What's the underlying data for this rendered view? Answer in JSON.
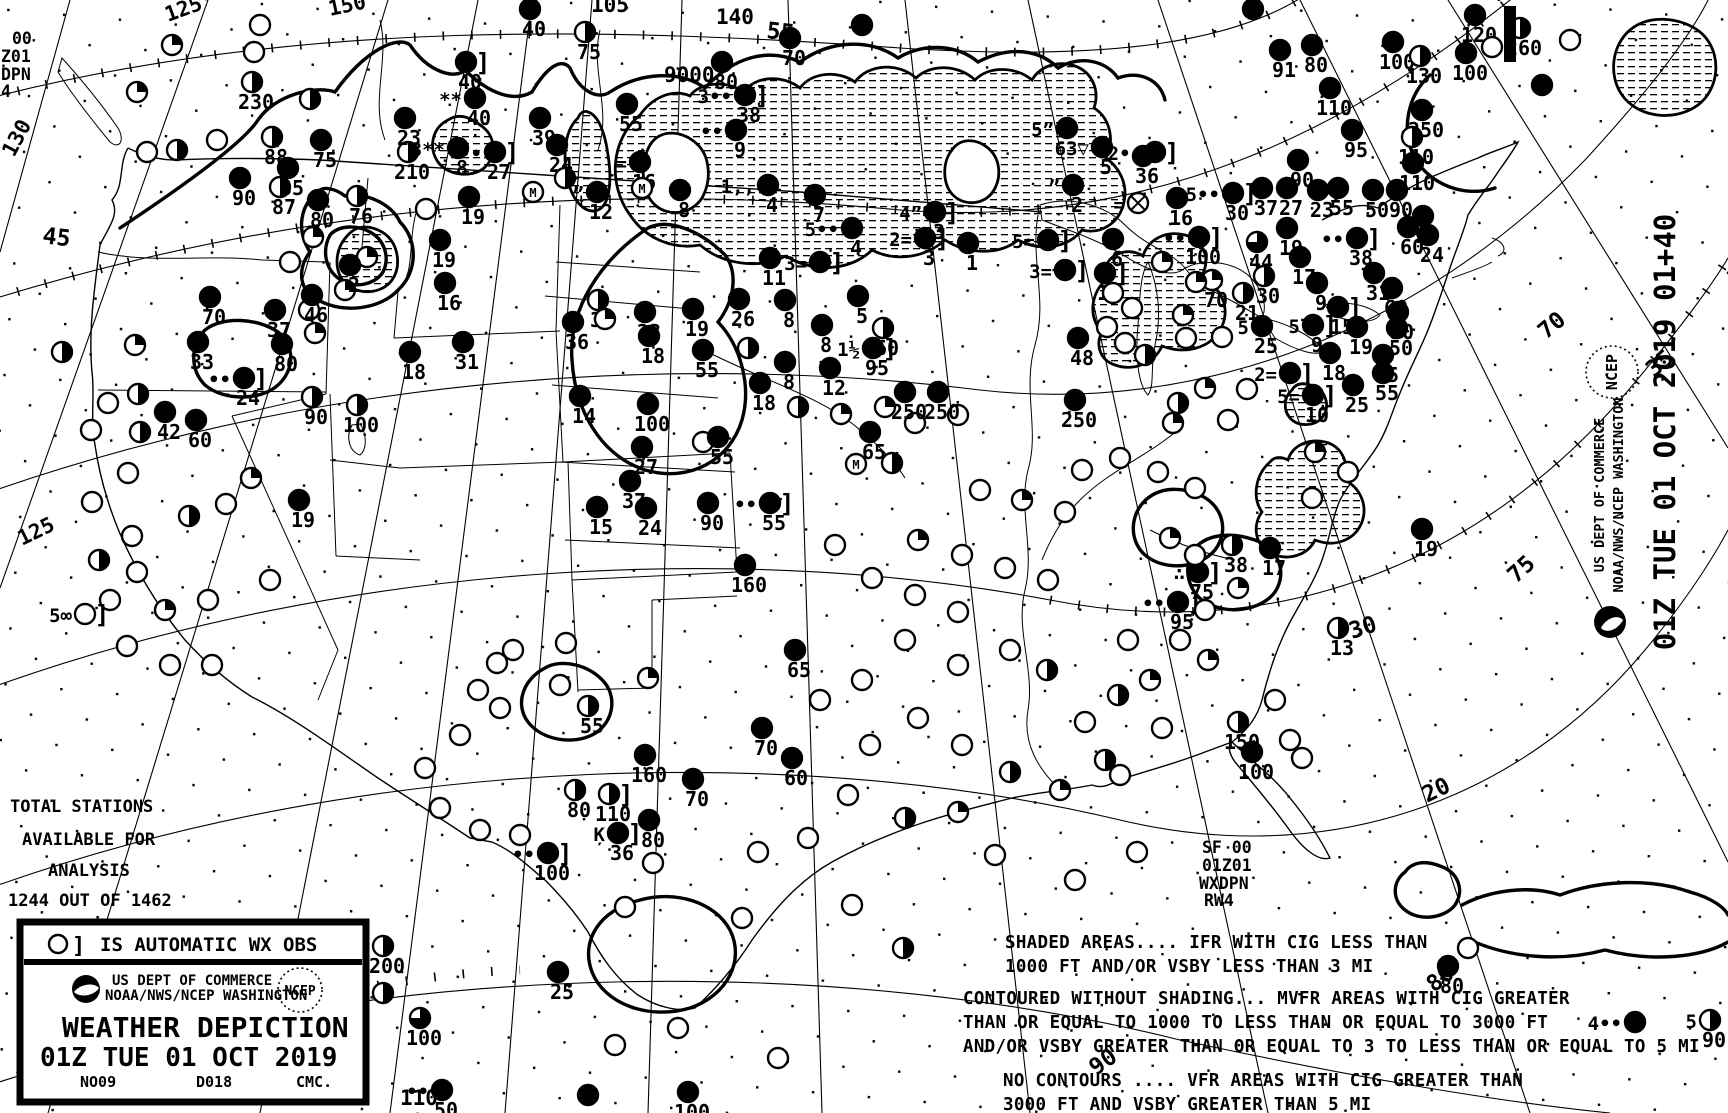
{
  "chart_title": "Weather Depiction Chart",
  "corner": [
    "00",
    "Z01",
    "DPN",
    "4"
  ],
  "totals": {
    "l1": "TOTAL STATIONS",
    "l2": "AVAILABLE FOR",
    "l3": "ANALYSIS",
    "l4": "1244 OUT OF 1462"
  },
  "sf": [
    "SF 00",
    "01Z01",
    "WXDPN",
    "RW4"
  ],
  "legend": {
    "auto_obs": "IS AUTOMATIC WX OBS",
    "bracket": "]",
    "dept": "US DEPT OF COMMERCE",
    "agency": "NOAA/NWS/NCEP WASHINGTON",
    "ncep": "NCEP",
    "title": "WEATHER DEPICTION",
    "datetime": "01Z TUE  01 OCT 2019",
    "code_left": "NO09",
    "code_mid": "D018",
    "code_right": "CMC."
  },
  "side": {
    "datetime": "01Z TUE  01 OCT 2019 01+40",
    "dept": "US DEPT OF COMMERCE",
    "agency": "NOAA/NWS/NCEP WASHINGTON",
    "ncep": "NCEP"
  },
  "notes": [
    "SHADED AREAS.... IFR WITH CIG LESS THAN",
    "1000 FT AND/OR VSBY LESS THAN 3 MI",
    "CONTOURED WITHOUT SHADING... MVFR AREAS WITH CIG GREATER",
    "THAN OR EQUAL TO 1000 TO LESS THAN OR EQUAL TO 3000 FT",
    "AND/OR VSBY GREATER THAN OR EQUAL TO 3 TO LESS THAN OR EQUAL TO 5 MI",
    "NO CONTOURS .... VFR AREAS WITH CIG GREATER THAN",
    "3000 FT AND VSBY GREATER THAN 5 MI"
  ],
  "graticule_labels": [
    [
      "125",
      168,
      22,
      -20
    ],
    [
      "150",
      330,
      16,
      -12
    ],
    [
      "105",
      591,
      12,
      0
    ],
    [
      "55",
      766,
      38,
      6
    ],
    [
      "140",
      716,
      24,
      0
    ],
    [
      "9000",
      664,
      82,
      0
    ],
    [
      "130",
      14,
      158,
      -62
    ],
    [
      "45",
      42,
      243,
      7
    ],
    [
      "125",
      22,
      546,
      -26
    ],
    [
      "120",
      30,
      1073,
      -18
    ],
    [
      "70",
      1546,
      340,
      -40
    ],
    [
      "75",
      1516,
      584,
      -42
    ],
    [
      "35",
      1654,
      378,
      -40
    ],
    [
      "30",
      1352,
      639,
      -18
    ],
    [
      "20",
      1427,
      803,
      -26
    ],
    [
      "90",
      1096,
      1076,
      -35
    ],
    [
      "80",
      1434,
      993,
      -38
    ],
    [
      "110",
      400,
      1105,
      0
    ]
  ],
  "station_format": "[x, y, type(o=open f=overcast h=half q=quarter tq=threequarter m=missing x=obscured), ceiling_value, wx_symbol, auto_obs_bracket]",
  "stations": [
    [
      172,
      45,
      "q"
    ],
    [
      260,
      25,
      "o"
    ],
    [
      254,
      52,
      "o"
    ],
    [
      252,
      82,
      "h",
      "230"
    ],
    [
      310,
      99,
      "h"
    ],
    [
      137,
      92,
      "q"
    ],
    [
      147,
      152,
      "o"
    ],
    [
      177,
      150,
      "h"
    ],
    [
      217,
      140,
      "o"
    ],
    [
      272,
      137,
      "h",
      "88"
    ],
    [
      321,
      140,
      "f",
      "75"
    ],
    [
      288,
      168,
      "f",
      "85"
    ],
    [
      240,
      178,
      "f",
      "90"
    ],
    [
      280,
      187,
      "h",
      "87"
    ],
    [
      318,
      200,
      "f",
      "80"
    ],
    [
      357,
      196,
      "h",
      "76"
    ],
    [
      408,
      152,
      "h",
      "210"
    ],
    [
      405,
      118,
      "f",
      "23"
    ],
    [
      469,
      197,
      "f",
      "19"
    ],
    [
      426,
      209,
      "o"
    ],
    [
      313,
      237,
      "q"
    ],
    [
      367,
      257,
      "q"
    ],
    [
      290,
      262,
      "o"
    ],
    [
      345,
      290,
      "q"
    ],
    [
      309,
      310,
      "o"
    ],
    [
      315,
      333,
      "q"
    ],
    [
      198,
      342,
      "f",
      "33"
    ],
    [
      210,
      297,
      "f",
      "70"
    ],
    [
      275,
      310,
      "f",
      "37"
    ],
    [
      312,
      295,
      "f",
      "46"
    ],
    [
      350,
      265,
      "f",
      "2"
    ],
    [
      244,
      378,
      "f",
      "24",
      "••",
      1
    ],
    [
      282,
      344,
      "f",
      "80"
    ],
    [
      410,
      352,
      "f",
      "18"
    ],
    [
      463,
      342,
      "f",
      "31"
    ],
    [
      312,
      397,
      "h",
      "90"
    ],
    [
      357,
      405,
      "h",
      "100"
    ],
    [
      135,
      345,
      "q"
    ],
    [
      62,
      352,
      "h"
    ],
    [
      108,
      403,
      "o"
    ],
    [
      165,
      412,
      "f",
      "42"
    ],
    [
      196,
      420,
      "f",
      "60"
    ],
    [
      138,
      394,
      "h"
    ],
    [
      140,
      432,
      "h"
    ],
    [
      91,
      430,
      "o"
    ],
    [
      128,
      473,
      "o"
    ],
    [
      92,
      502,
      "o"
    ],
    [
      132,
      536,
      "o"
    ],
    [
      99,
      560,
      "h"
    ],
    [
      137,
      572,
      "o"
    ],
    [
      110,
      600,
      "o"
    ],
    [
      165,
      610,
      "q"
    ],
    [
      208,
      600,
      "o"
    ],
    [
      127,
      646,
      "o"
    ],
    [
      170,
      665,
      "o"
    ],
    [
      212,
      665,
      "o"
    ],
    [
      270,
      580,
      "o"
    ],
    [
      251,
      478,
      "q"
    ],
    [
      226,
      504,
      "o"
    ],
    [
      189,
      516,
      "h"
    ],
    [
      85,
      614,
      "o",
      "",
      "5∞",
      1
    ],
    [
      299,
      500,
      "f",
      "19"
    ],
    [
      440,
      240,
      "f",
      "19"
    ],
    [
      445,
      283,
      "f",
      "16"
    ],
    [
      466,
      62,
      "f",
      "40",
      "",
      1
    ],
    [
      475,
      98,
      "f",
      "40",
      "**"
    ],
    [
      458,
      148,
      "f",
      "8",
      "3**"
    ],
    [
      495,
      152,
      "f",
      "27",
      "••",
      1
    ],
    [
      540,
      118,
      "f",
      "39"
    ],
    [
      585,
      32,
      "h",
      "75"
    ],
    [
      530,
      9,
      "f",
      "40"
    ],
    [
      627,
      104,
      "f",
      "55"
    ],
    [
      557,
      145,
      "f",
      "24"
    ],
    [
      597,
      192,
      "f",
      "12",
      "”"
    ],
    [
      640,
      162,
      "f",
      "16",
      "="
    ],
    [
      680,
      190,
      "f",
      "8"
    ],
    [
      736,
      130,
      "f",
      "9",
      "••"
    ],
    [
      745,
      95,
      "f",
      "38",
      "3••",
      1
    ],
    [
      768,
      185,
      "f",
      "4",
      "1,,"
    ],
    [
      1067,
      128,
      "f",
      "",
      "5”"
    ],
    [
      1102,
      147,
      "f",
      "5",
      "63▽"
    ],
    [
      1073,
      185,
      "f",
      "2",
      "”"
    ],
    [
      935,
      212,
      "f",
      "3",
      "4”",
      1
    ],
    [
      852,
      228,
      "f",
      "4",
      "5••"
    ],
    [
      925,
      238,
      "f",
      "3",
      "2=",
      1
    ],
    [
      968,
      243,
      "f",
      "1"
    ],
    [
      1048,
      240,
      "f",
      "",
      "5=",
      1
    ],
    [
      770,
      258,
      "f",
      "11"
    ],
    [
      820,
      262,
      "f",
      "",
      "3=",
      1
    ],
    [
      1065,
      270,
      "f",
      "",
      "3=",
      1
    ],
    [
      815,
      195,
      "f",
      "7"
    ],
    [
      722,
      62,
      "f",
      "80"
    ],
    [
      790,
      38,
      "f",
      "70"
    ],
    [
      862,
      25,
      "f"
    ],
    [
      533,
      192,
      "m"
    ],
    [
      642,
      188,
      "m"
    ],
    [
      565,
      178,
      "h"
    ],
    [
      785,
      300,
      "f",
      "8"
    ],
    [
      822,
      325,
      "f",
      "8"
    ],
    [
      785,
      362,
      "f",
      "8"
    ],
    [
      858,
      296,
      "f",
      "5"
    ],
    [
      883,
      328,
      "h",
      "60"
    ],
    [
      873,
      348,
      "f",
      "95",
      "1½",
      1
    ],
    [
      830,
      368,
      "f",
      "12"
    ],
    [
      1078,
      338,
      "f",
      "48"
    ],
    [
      598,
      300,
      "h",
      "31"
    ],
    [
      573,
      322,
      "f",
      "36"
    ],
    [
      645,
      312,
      "f",
      "23"
    ],
    [
      693,
      309,
      "f",
      "19"
    ],
    [
      739,
      299,
      "f",
      "26"
    ],
    [
      649,
      336,
      "f",
      "18"
    ],
    [
      703,
      350,
      "f",
      "55"
    ],
    [
      580,
      396,
      "f",
      "14"
    ],
    [
      648,
      404,
      "f",
      "100"
    ],
    [
      748,
      348,
      "h"
    ],
    [
      703,
      442,
      "o"
    ],
    [
      642,
      447,
      "f",
      "27"
    ],
    [
      630,
      481,
      "f",
      "37"
    ],
    [
      597,
      507,
      "f",
      "15"
    ],
    [
      646,
      508,
      "f",
      "24"
    ],
    [
      708,
      503,
      "f",
      "90"
    ],
    [
      770,
      503,
      "f",
      "55",
      "••",
      1
    ],
    [
      605,
      319,
      "q"
    ],
    [
      760,
      383,
      "f",
      "18"
    ],
    [
      798,
      407,
      "h"
    ],
    [
      870,
      432,
      "f",
      "65"
    ],
    [
      841,
      414,
      "q"
    ],
    [
      885,
      407,
      "q"
    ],
    [
      856,
      464,
      "m"
    ],
    [
      892,
      463,
      "h"
    ],
    [
      915,
      423,
      "o"
    ],
    [
      958,
      415,
      "o"
    ],
    [
      905,
      392,
      "f",
      "250"
    ],
    [
      938,
      392,
      "f",
      "250"
    ],
    [
      1075,
      400,
      "f",
      "250"
    ],
    [
      718,
      437,
      "f",
      "55"
    ],
    [
      1143,
      156,
      "f",
      "36"
    ],
    [
      1155,
      152,
      "f",
      "",
      "2••",
      1
    ],
    [
      1138,
      203,
      "x",
      "",
      "="
    ],
    [
      1113,
      239,
      "f",
      "6"
    ],
    [
      1105,
      273,
      "f",
      "14",
      "",
      1
    ],
    [
      1162,
      262,
      "q"
    ],
    [
      1113,
      293,
      "o"
    ],
    [
      1132,
      308,
      "o"
    ],
    [
      1107,
      327,
      "o"
    ],
    [
      1125,
      343,
      "o"
    ],
    [
      1145,
      355,
      "h"
    ],
    [
      1232,
      545,
      "h",
      "38"
    ],
    [
      1270,
      548,
      "f",
      "17"
    ],
    [
      1198,
      572,
      "f",
      "75",
      "∴",
      1
    ],
    [
      1178,
      602,
      "f",
      "95",
      "••",
      1
    ],
    [
      1238,
      588,
      "q"
    ],
    [
      1422,
      529,
      "f",
      "19"
    ],
    [
      1338,
      628,
      "h",
      "13"
    ],
    [
      1238,
      722,
      "h",
      "150"
    ],
    [
      1252,
      752,
      "f",
      "100"
    ],
    [
      1290,
      740,
      "o"
    ],
    [
      1275,
      700,
      "o"
    ],
    [
      1208,
      660,
      "q"
    ],
    [
      1162,
      728,
      "o"
    ],
    [
      1120,
      775,
      "o"
    ],
    [
      995,
      855,
      "o"
    ],
    [
      1137,
      852,
      "o"
    ],
    [
      1075,
      880,
      "o"
    ],
    [
      1302,
      758,
      "o"
    ],
    [
      1180,
      640,
      "o"
    ],
    [
      1205,
      610,
      "o"
    ],
    [
      1128,
      640,
      "o"
    ],
    [
      1150,
      680,
      "q"
    ],
    [
      1118,
      695,
      "h"
    ],
    [
      1085,
      722,
      "o"
    ],
    [
      1105,
      760,
      "h"
    ],
    [
      1060,
      790,
      "q"
    ],
    [
      1010,
      772,
      "h"
    ],
    [
      962,
      745,
      "o"
    ],
    [
      918,
      718,
      "o"
    ],
    [
      905,
      818,
      "h"
    ],
    [
      958,
      812,
      "q"
    ],
    [
      848,
      795,
      "o"
    ],
    [
      870,
      745,
      "o"
    ],
    [
      1195,
      555,
      "o"
    ],
    [
      1170,
      538,
      "q"
    ],
    [
      1312,
      498,
      "o"
    ],
    [
      1348,
      472,
      "o"
    ],
    [
      1315,
      452,
      "q"
    ],
    [
      1082,
      470,
      "o"
    ],
    [
      1120,
      458,
      "o"
    ],
    [
      1158,
      472,
      "o"
    ],
    [
      1195,
      488,
      "o"
    ],
    [
      980,
      490,
      "o"
    ],
    [
      1022,
      500,
      "q"
    ],
    [
      1065,
      512,
      "o"
    ],
    [
      918,
      540,
      "q"
    ],
    [
      962,
      555,
      "o"
    ],
    [
      1005,
      568,
      "o"
    ],
    [
      1048,
      580,
      "o"
    ],
    [
      872,
      578,
      "o"
    ],
    [
      915,
      595,
      "o"
    ],
    [
      958,
      612,
      "o"
    ],
    [
      835,
      545,
      "o"
    ],
    [
      905,
      640,
      "o"
    ],
    [
      958,
      665,
      "o"
    ],
    [
      1010,
      650,
      "o"
    ],
    [
      1047,
      670,
      "h"
    ],
    [
      862,
      680,
      "o"
    ],
    [
      820,
      700,
      "o"
    ],
    [
      648,
      678,
      "q"
    ],
    [
      588,
      706,
      "h",
      "55"
    ],
    [
      645,
      755,
      "f",
      "160"
    ],
    [
      609,
      794,
      "h",
      "110",
      "",
      1
    ],
    [
      575,
      790,
      "h",
      "80"
    ],
    [
      693,
      779,
      "f",
      "70"
    ],
    [
      649,
      820,
      "f",
      "80"
    ],
    [
      618,
      833,
      "f",
      "36",
      "Ķ",
      1
    ],
    [
      548,
      853,
      "f",
      "100",
      "••",
      1
    ],
    [
      520,
      835,
      "o"
    ],
    [
      480,
      830,
      "o"
    ],
    [
      440,
      808,
      "o"
    ],
    [
      425,
      768,
      "o"
    ],
    [
      460,
      735,
      "o"
    ],
    [
      500,
      708,
      "o"
    ],
    [
      478,
      690,
      "o"
    ],
    [
      560,
      685,
      "o"
    ],
    [
      566,
      643,
      "o"
    ],
    [
      513,
      650,
      "o"
    ],
    [
      497,
      663,
      "o"
    ],
    [
      653,
      863,
      "o"
    ],
    [
      625,
      907,
      "o"
    ],
    [
      758,
      852,
      "o"
    ],
    [
      808,
      838,
      "o"
    ],
    [
      742,
      918,
      "o"
    ],
    [
      852,
      905,
      "o"
    ],
    [
      903,
      948,
      "h"
    ],
    [
      762,
      728,
      "f",
      "70"
    ],
    [
      745,
      565,
      "f",
      "160"
    ],
    [
      795,
      650,
      "f",
      "65"
    ],
    [
      792,
      758,
      "f",
      "60"
    ],
    [
      558,
      972,
      "f",
      "25"
    ],
    [
      383,
      946,
      "h",
      "200"
    ],
    [
      420,
      1018,
      "tq",
      "100"
    ],
    [
      383,
      993,
      "h"
    ],
    [
      442,
      1090,
      "f",
      "50",
      "••"
    ],
    [
      588,
      1095,
      "f"
    ],
    [
      688,
      1092,
      "f",
      "100"
    ],
    [
      615,
      1045,
      "o"
    ],
    [
      678,
      1028,
      "o"
    ],
    [
      778,
      1058,
      "o"
    ],
    [
      1448,
      966,
      "f",
      "80"
    ],
    [
      1468,
      948,
      "o"
    ],
    [
      1635,
      1022,
      "f",
      "",
      "4••"
    ],
    [
      1710,
      1020,
      "h",
      "90",
      "5"
    ],
    [
      1177,
      198,
      "f",
      "16"
    ],
    [
      1233,
      193,
      "f",
      "30",
      "5••",
      1
    ],
    [
      1262,
      188,
      "f",
      "37"
    ],
    [
      1287,
      188,
      "f",
      "27"
    ],
    [
      1318,
      190,
      "f",
      "23",
      "",
      1
    ],
    [
      1338,
      188,
      "f",
      "55"
    ],
    [
      1373,
      190,
      "f",
      "50"
    ],
    [
      1397,
      190,
      "f",
      "90"
    ],
    [
      1423,
      216,
      "f",
      "14"
    ],
    [
      1408,
      227,
      "f",
      "60"
    ],
    [
      1428,
      235,
      "f",
      "24"
    ],
    [
      1199,
      237,
      "f",
      "100",
      "••",
      1
    ],
    [
      1257,
      242,
      "tq",
      "44"
    ],
    [
      1287,
      228,
      "f",
      "19"
    ],
    [
      1300,
      257,
      "f",
      "17"
    ],
    [
      1357,
      238,
      "f",
      "38",
      "••",
      1
    ],
    [
      1264,
      276,
      "h",
      "30"
    ],
    [
      1243,
      293,
      "h",
      "21"
    ],
    [
      1212,
      280,
      "q",
      "70"
    ],
    [
      1317,
      283,
      "f",
      "9"
    ],
    [
      1338,
      307,
      "f",
      "15",
      "",
      1
    ],
    [
      1374,
      273,
      "f",
      "31"
    ],
    [
      1392,
      288,
      "f",
      "60"
    ],
    [
      1398,
      312,
      "f",
      "50"
    ],
    [
      1397,
      328,
      "f",
      "50"
    ],
    [
      1357,
      327,
      "f",
      "19"
    ],
    [
      1383,
      355,
      "f",
      "45"
    ],
    [
      1383,
      373,
      "f",
      "55"
    ],
    [
      1330,
      353,
      "f",
      "18"
    ],
    [
      1353,
      385,
      "f",
      "25"
    ],
    [
      1313,
      325,
      "f",
      "9",
      "5",
      1
    ],
    [
      1262,
      326,
      "f",
      "25",
      "5"
    ],
    [
      1290,
      373,
      "f",
      "",
      "2=",
      1
    ],
    [
      1313,
      395,
      "f",
      "10",
      "5=",
      1
    ],
    [
      1196,
      282,
      "q"
    ],
    [
      1183,
      315,
      "q"
    ],
    [
      1222,
      337,
      "o"
    ],
    [
      1186,
      338,
      "o"
    ],
    [
      1205,
      388,
      "q"
    ],
    [
      1178,
      403,
      "h"
    ],
    [
      1247,
      389,
      "o"
    ],
    [
      1173,
      423,
      "q"
    ],
    [
      1228,
      420,
      "o"
    ],
    [
      1298,
      160,
      "f",
      "90"
    ],
    [
      1475,
      15,
      "f",
      "120"
    ],
    [
      1520,
      28,
      "h",
      "260"
    ],
    [
      1280,
      50,
      "f",
      "91"
    ],
    [
      1312,
      45,
      "f",
      "80"
    ],
    [
      1393,
      42,
      "f",
      "100"
    ],
    [
      1420,
      56,
      "h",
      "130"
    ],
    [
      1466,
      53,
      "f",
      "100"
    ],
    [
      1492,
      47,
      "o"
    ],
    [
      1330,
      88,
      "f",
      "110"
    ],
    [
      1352,
      130,
      "f",
      "95"
    ],
    [
      1422,
      110,
      "f",
      "250"
    ],
    [
      1412,
      137,
      "h",
      "110"
    ],
    [
      1413,
      163,
      "f",
      "110"
    ],
    [
      1542,
      85,
      "f"
    ],
    [
      1570,
      40,
      "o"
    ],
    [
      1253,
      9,
      "f"
    ]
  ]
}
